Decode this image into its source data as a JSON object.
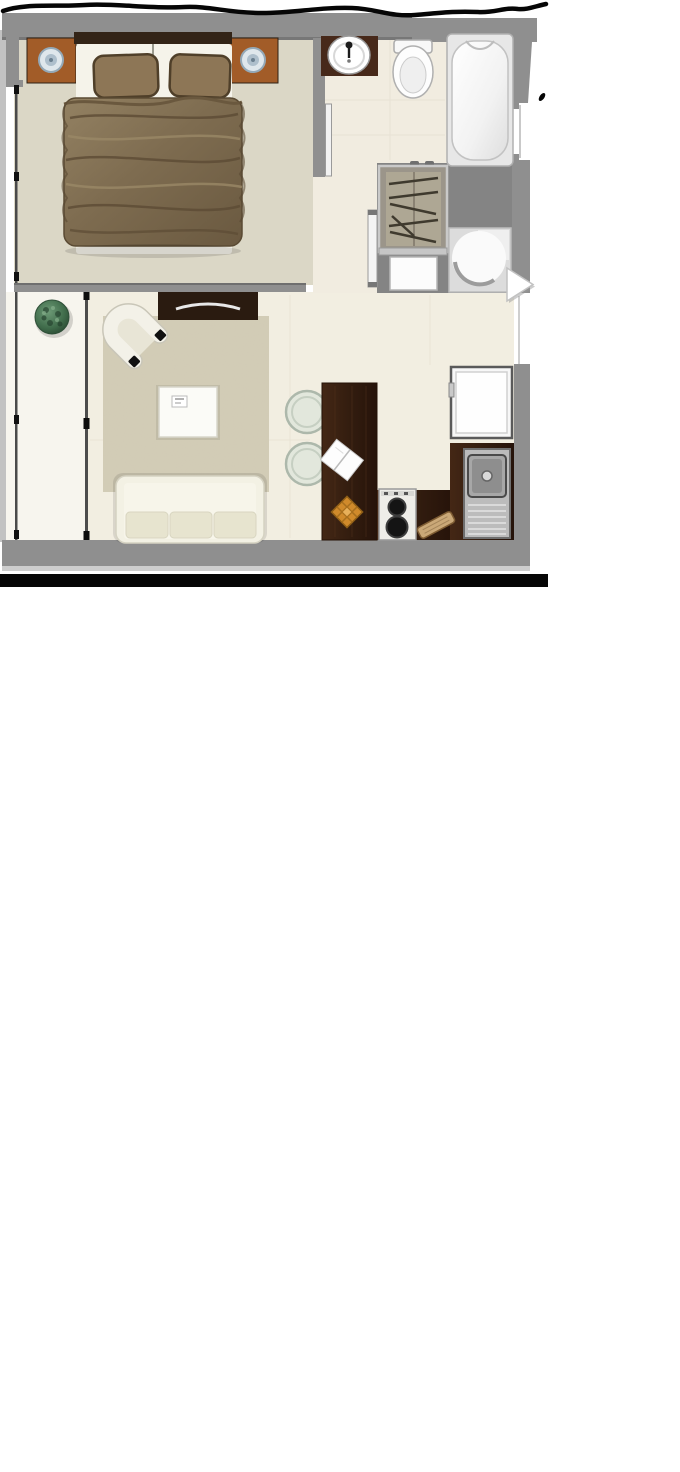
{
  "meta": {
    "type": "floor-plan",
    "description": "studio-apartment-floor-plan-top-view"
  },
  "colors": {
    "wall": "#8f8f8f",
    "wall_edge": "#6f6f6f",
    "outer_frame": "#c2c2c2",
    "bedroom_floor": "#dbd7c6",
    "living_floor": "#f2eee1",
    "bathroom_floor": "#f1ece0",
    "balcony_floor": "#f7f5ee",
    "hall_floor": "#848484",
    "rug": "#d6d0bb",
    "tv_console_wood": "#2a1b10",
    "counter_wood": "#3a2113",
    "sink_counter_wood": "#47291a",
    "nightstand_wood": "#a25c28",
    "headboard_wood": "#332417",
    "blanket": "#7e6c50",
    "pillow": "#8d7656",
    "sofa_white": "#f3f1e4",
    "fixture_white": "#fbfbfb",
    "stainless": "#bcbcbc",
    "plant_green": "#3f6b4a",
    "trivet_orange": "#d08a2b",
    "stool_green": "#e2e7dc",
    "board_wood": "#caa878",
    "marker_black": "#060606",
    "arrow_white": "#ffffff"
  },
  "rooms": {
    "bedroom": "bedroom",
    "bathroom": "bathroom",
    "living": "living-area",
    "kitchen": "kitchen",
    "hall": "entry-hall",
    "balcony": "balcony"
  },
  "icons": [
    "double-bed",
    "pillow",
    "blanket",
    "headboard",
    "nightstand",
    "bedside-lamp",
    "bathroom-sink",
    "toilet",
    "bathtub",
    "wardrobe-with-hangers",
    "laundry-appliance",
    "washing-machine",
    "door-leaf",
    "tv-console",
    "television",
    "area-rug",
    "armchair",
    "coffee-table",
    "remote-control",
    "sofa",
    "potted-plant",
    "dining-stool",
    "kitchen-island",
    "napkin",
    "trivet",
    "cooktop",
    "kitchen-sink",
    "refrigerator",
    "cutting-board",
    "window",
    "sliding-glass-door",
    "next-arrow",
    "marker-scribble"
  ],
  "overlay": {
    "arrow_direction": "right"
  }
}
